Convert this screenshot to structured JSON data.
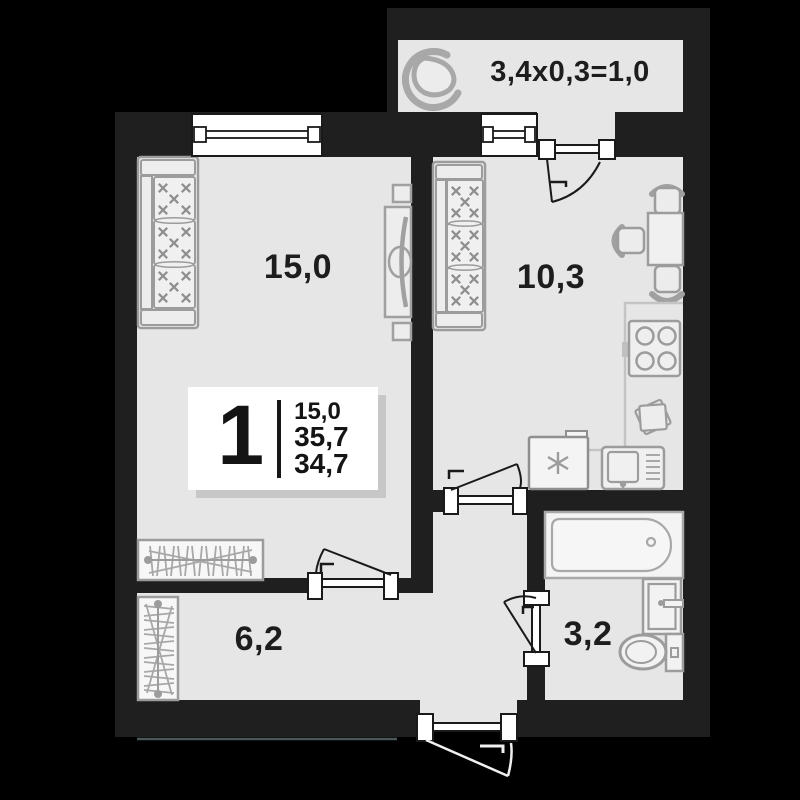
{
  "floor_plan": {
    "balcony": {
      "name": "balcony",
      "area_formula": "3,4x0,3=1,0"
    },
    "living_room": {
      "name": "living-room",
      "area": "15,0"
    },
    "kitchen": {
      "name": "kitchen",
      "area": "10,3"
    },
    "hallway": {
      "name": "hallway",
      "area": "6,2"
    },
    "bathroom": {
      "name": "bathroom",
      "area": "3,2"
    },
    "summary_card": {
      "rooms_count": "1",
      "living_area": "15,0",
      "total_area": "35,7",
      "reduced_area": "34,7"
    },
    "colors": {
      "page_background": "#000000",
      "walls": "#1f1f1f",
      "floor": "#e6e6e6",
      "furniture_stroke": "#9c9c9c",
      "fixture_stroke": "#a8a8a8",
      "text": "#1d1d1d",
      "card_background": "#ffffff",
      "card_shadow": "#c7c7c7",
      "door_window_stroke": "#1a1a1a",
      "exterior_door_swing": "#f0f0f0"
    },
    "furniture_icons": [
      "armchair-icon",
      "living-sofa-icon",
      "kitchen-sofa-icon",
      "tv-stand-icon",
      "speaker-icon",
      "living-wardrobe-icon",
      "hall-wardrobe-icon",
      "dining-table-icon",
      "dining-chair-icon",
      "stove-icon",
      "cutting-board-icon",
      "fridge-icon",
      "kitchen-sink-icon",
      "kitchen-counter-outline",
      "bathtub-icon",
      "washbasin-icon",
      "toilet-icon",
      "window-icon",
      "door-icon"
    ]
  }
}
